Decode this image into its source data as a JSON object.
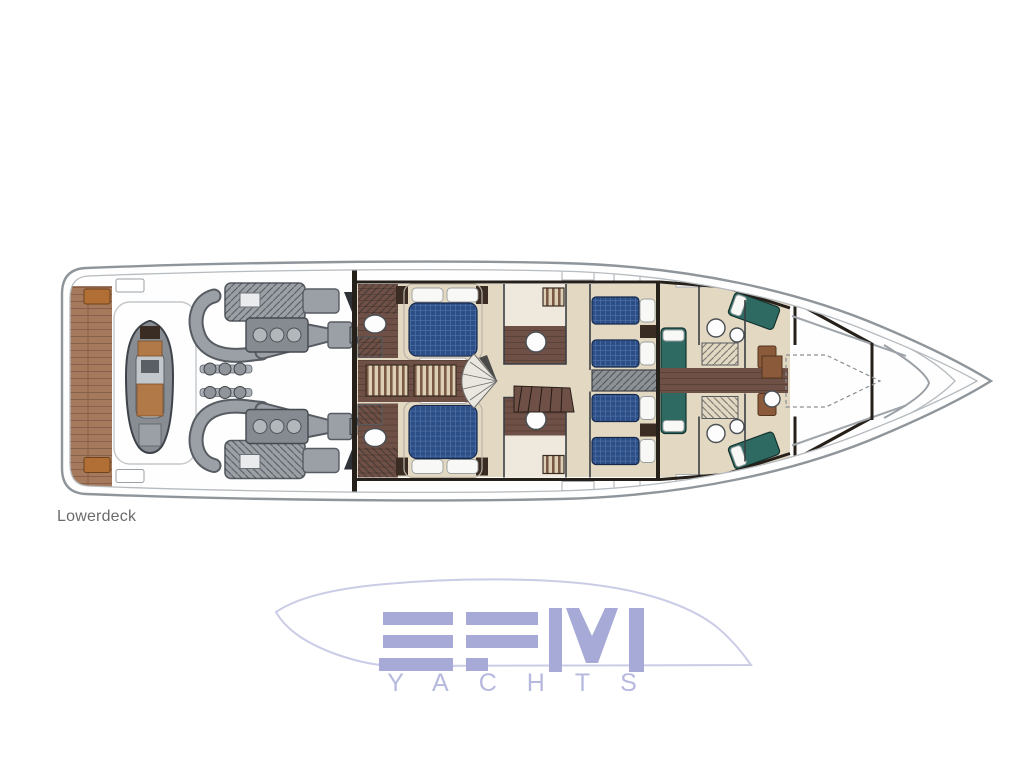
{
  "page": {
    "background": "#ffffff"
  },
  "plan": {
    "deck_label": "Lowerdeck",
    "zones": [
      {
        "id": "swim-platform",
        "label": "teak swim platform"
      },
      {
        "id": "tender-garage",
        "label": "tender on chocks"
      },
      {
        "id": "engine-room",
        "label": "twin engines with exhausts"
      },
      {
        "id": "guest-cabin-port",
        "label": "double guest cabin port"
      },
      {
        "id": "guest-cabin-starboard",
        "label": "double guest cabin starboard"
      },
      {
        "id": "wardrobes",
        "label": "wardrobe lockers"
      },
      {
        "id": "lobby-stairs",
        "label": "central lobby staircases"
      },
      {
        "id": "twin-cabins",
        "label": "twin guest cabins"
      },
      {
        "id": "crew-quarters",
        "label": "crew cabins and bathrooms"
      },
      {
        "id": "bow-locker",
        "label": "forepeak storage"
      }
    ]
  },
  "watermark": {
    "brand": "EFM",
    "sub": "YACHTS"
  },
  "theme": {
    "page-bg": "#ffffff",
    "hull-line": "#8e959b",
    "hull-inner": "#b6bbbf",
    "wall": "#26201a",
    "floor": "#e3d8c2",
    "floor-light": "#efe9dd",
    "teak": "#a57a5c",
    "teak-line": "#86604a",
    "cleat": "#b26f35",
    "wood": "#6f5046",
    "wood-line": "#594036",
    "wardrobe-bg": "#dccfb6",
    "wardrobe-stripe": "#7a5a44",
    "bed-blue": "#2b4e86",
    "bed-grid": "#4d6da3",
    "bed-teal": "#2f6a62",
    "pillow": "#f8f8f6",
    "engine": "#9aa0a6",
    "engine-dark": "#565c62",
    "tender": "#888d93",
    "tender-dark": "#3e434a",
    "tender-seat": "#b27948",
    "fixture": "#4a4f54",
    "label": "#6b6b6b",
    "logo": "#a7aad6",
    "logo-sub": "#b6b9de",
    "logo-outline": "#cbcde7"
  }
}
